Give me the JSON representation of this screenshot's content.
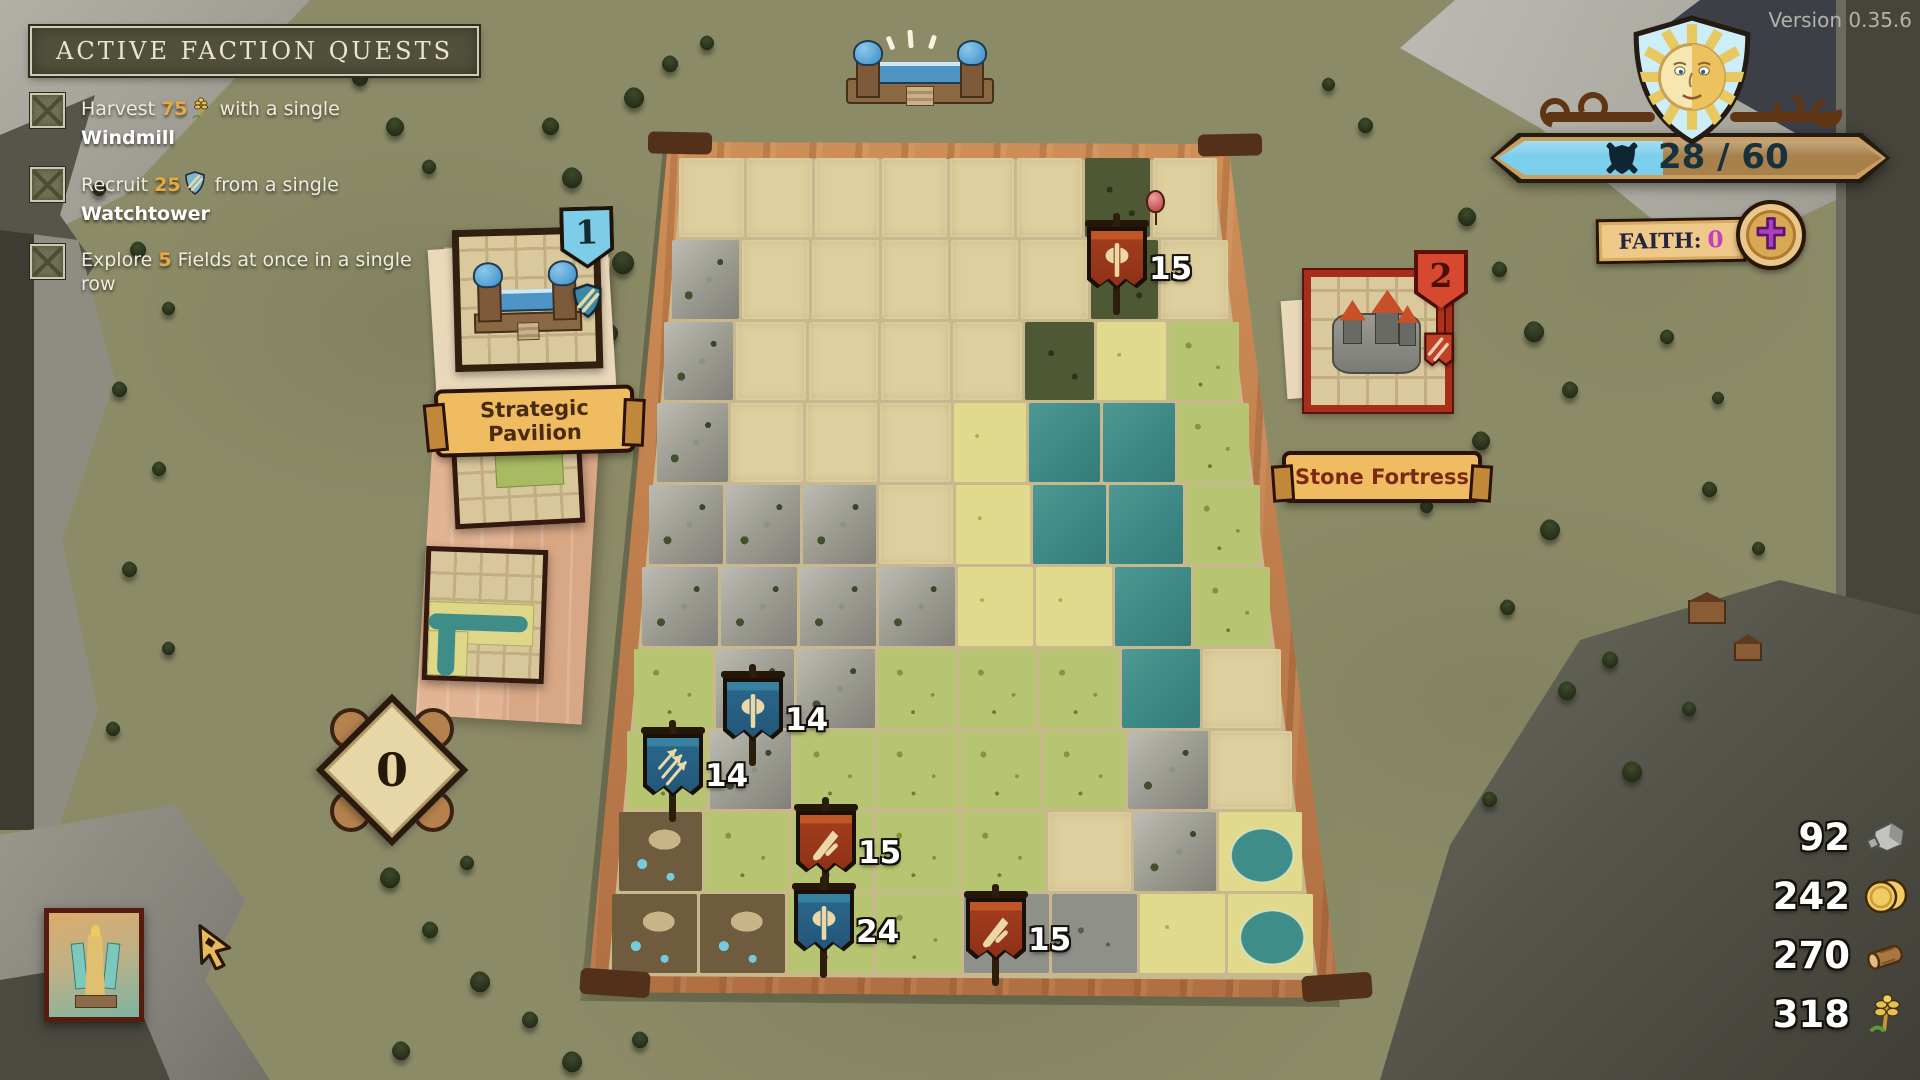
{
  "version_label": "Version 0.35.6",
  "quests": {
    "title": "ACTIVE FACTION QUESTS",
    "items": [
      {
        "pre": "Harvest ",
        "value": "75",
        "icon": "wheat-icon",
        "mid": " with a single ",
        "emph": "Windmill"
      },
      {
        "pre": "Recruit ",
        "value": "25",
        "icon": "recruit-shield-icon",
        "mid": " from a single ",
        "emph": "Watchtower"
      },
      {
        "pre": "Explore ",
        "value": "5",
        "icon": "",
        "mid": " Fields at once in a single row",
        "emph": ""
      }
    ]
  },
  "war": {
    "score": "28 / 60",
    "emblem": "sun-shield-icon",
    "bar_icon": "shield-swords-icon",
    "fill_color": "#7bcfec"
  },
  "faith": {
    "label": "FAITH:",
    "value": "0",
    "icon": "faith-cross-icon",
    "value_color": "#c53cc5"
  },
  "buildings": {
    "left_card": {
      "badge": "1",
      "title": "Strategic Pavilion",
      "crest": "blue-arrows-shield-icon",
      "badge_color": "#7ecde8"
    },
    "right_card": {
      "badge": "2",
      "title": "Stone Fortress",
      "crest": "red-arrows-banner-icon",
      "badge_color": "#d64830"
    }
  },
  "tile_tray": {
    "deck_counter": "0"
  },
  "resources": [
    {
      "value": "92",
      "icon": "stone-icon"
    },
    {
      "value": "242",
      "icon": "coins-icon"
    },
    {
      "value": "270",
      "icon": "wood-icon"
    },
    {
      "value": "318",
      "icon": "wheat-icon"
    }
  ],
  "board": {
    "tile_map": [
      "EEEEEEDE",
      "MEEEEEDE",
      "MEEEEDYG",
      "MEEEYWWG",
      "MMMEYWWG",
      "MMMMYYWG",
      "GMMGGGWE",
      "GMGGGGME",
      "BGGGGEML",
      "BBGGRRYL"
    ],
    "flags": [
      {
        "value": "15",
        "color": "red",
        "emblem": "axe",
        "x": 1085,
        "y": 213
      },
      {
        "value": "14",
        "color": "blue",
        "emblem": "axe",
        "x": 721,
        "y": 664
      },
      {
        "value": "14",
        "color": "blue",
        "emblem": "arrows",
        "x": 641,
        "y": 720
      },
      {
        "value": "15",
        "color": "red",
        "emblem": "sword",
        "x": 794,
        "y": 797
      },
      {
        "value": "24",
        "color": "blue",
        "emblem": "axe",
        "x": 792,
        "y": 876
      },
      {
        "value": "15",
        "color": "red",
        "emblem": "sword",
        "x": 964,
        "y": 884
      }
    ]
  }
}
